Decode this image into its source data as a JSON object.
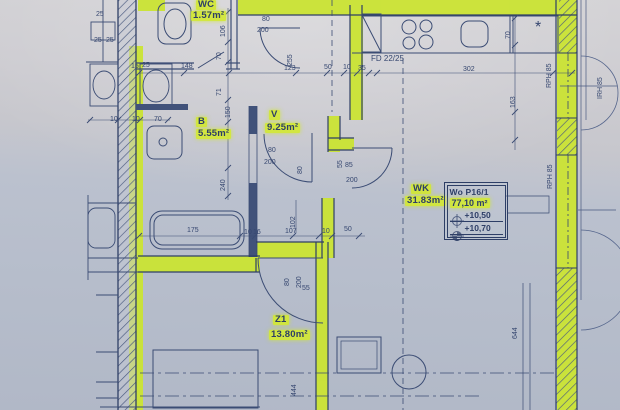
{
  "document": {
    "kind": "architectural floor plan (photographed)"
  },
  "colors": {
    "highlight": "#cde32e",
    "ink": "#364770",
    "wall_line": "#2f3f66",
    "paper_top": "#d3d2d5",
    "paper_bottom": "#b1b8c7"
  },
  "rooms": [
    {
      "label": "WC",
      "area": "1.57m²",
      "label_pos": {
        "x": 196,
        "y": 0
      },
      "area_pos": {
        "x": 191,
        "y": 11
      }
    },
    {
      "label": "B",
      "area": "5.55m²",
      "label_pos": {
        "x": 196,
        "y": 117
      },
      "area_pos": {
        "x": 196,
        "y": 129
      }
    },
    {
      "label": "V",
      "area": "9.25m²",
      "label_pos": {
        "x": 269,
        "y": 110
      },
      "area_pos": {
        "x": 265,
        "y": 123
      }
    },
    {
      "label": "WK",
      "area": "31.83m²",
      "label_pos": {
        "x": 411,
        "y": 184
      },
      "area_pos": {
        "x": 405,
        "y": 196
      }
    },
    {
      "label": "Z1",
      "area": "13.80m²",
      "label_pos": {
        "x": 273,
        "y": 315
      },
      "area_pos": {
        "x": 269,
        "y": 330
      }
    }
  ],
  "info_box": {
    "unit": "Wo P16/1",
    "area": "77,10 m²",
    "levels": [
      {
        "symbol": "level-crosshair",
        "value": "+10,50"
      },
      {
        "symbol": "level-benchmark",
        "value": "+10,70"
      }
    ]
  },
  "dimensions": [
    {
      "t": "80",
      "x": 262,
      "y": 16
    },
    {
      "t": "200",
      "x": 257,
      "y": 27
    },
    {
      "t": "106",
      "x": 220,
      "y": 37,
      "r": -90
    },
    {
      "t": "70",
      "x": 216,
      "y": 60,
      "r": -90
    },
    {
      "t": "71",
      "x": 216,
      "y": 96,
      "r": -90
    },
    {
      "t": "148",
      "x": 181,
      "y": 63
    },
    {
      "t": "15",
      "x": 131,
      "y": 63
    },
    {
      "t": "25",
      "x": 142,
      "y": 62
    },
    {
      "t": "255",
      "x": 287,
      "y": 66,
      "r": -90
    },
    {
      "t": "123",
      "x": 284,
      "y": 65
    },
    {
      "t": "50",
      "x": 324,
      "y": 64
    },
    {
      "t": "10",
      "x": 343,
      "y": 64
    },
    {
      "t": "35",
      "x": 358,
      "y": 65
    },
    {
      "t": "FD 22/25",
      "x": 371,
      "y": 55,
      "s": 8
    },
    {
      "t": "302",
      "x": 463,
      "y": 66
    },
    {
      "t": "70",
      "x": 505,
      "y": 39,
      "r": -90
    },
    {
      "t": "163",
      "x": 510,
      "y": 108,
      "r": -90
    },
    {
      "t": "RPH 85",
      "x": 546,
      "y": 88,
      "r": -90
    },
    {
      "t": "IRH 85",
      "x": 597,
      "y": 99,
      "r": -90
    },
    {
      "t": "RPH 85",
      "x": 547,
      "y": 189,
      "r": -90
    },
    {
      "t": "25",
      "x": 96,
      "y": 11
    },
    {
      "t": "25",
      "x": 94,
      "y": 37
    },
    {
      "t": "25",
      "x": 106,
      "y": 37
    },
    {
      "t": "10",
      "x": 110,
      "y": 116
    },
    {
      "t": "10",
      "x": 132,
      "y": 116
    },
    {
      "t": "70",
      "x": 154,
      "y": 116
    },
    {
      "t": "150",
      "x": 225,
      "y": 118,
      "r": -90
    },
    {
      "t": "240",
      "x": 220,
      "y": 191,
      "r": -90
    },
    {
      "t": "80",
      "x": 268,
      "y": 147
    },
    {
      "t": "200",
      "x": 264,
      "y": 159
    },
    {
      "t": "80",
      "x": 297,
      "y": 174,
      "r": -90
    },
    {
      "t": "55",
      "x": 337,
      "y": 168,
      "r": -90
    },
    {
      "t": "85",
      "x": 345,
      "y": 162
    },
    {
      "t": "200",
      "x": 346,
      "y": 177
    },
    {
      "t": "175",
      "x": 187,
      "y": 227
    },
    {
      "t": "10",
      "x": 244,
      "y": 229
    },
    {
      "t": "16",
      "x": 253,
      "y": 229
    },
    {
      "t": "102",
      "x": 290,
      "y": 228,
      "r": -90
    },
    {
      "t": "107",
      "x": 285,
      "y": 228
    },
    {
      "t": "10",
      "x": 322,
      "y": 228
    },
    {
      "t": "50",
      "x": 344,
      "y": 226
    },
    {
      "t": "80",
      "x": 284,
      "y": 286,
      "r": -90
    },
    {
      "t": "200",
      "x": 296,
      "y": 288,
      "r": -90
    },
    {
      "t": "55",
      "x": 302,
      "y": 285
    },
    {
      "t": "444",
      "x": 291,
      "y": 396,
      "r": -90
    },
    {
      "t": "644",
      "x": 512,
      "y": 339,
      "r": -90
    },
    {
      "t": "*",
      "x": 535,
      "y": 19,
      "s": 16
    }
  ]
}
